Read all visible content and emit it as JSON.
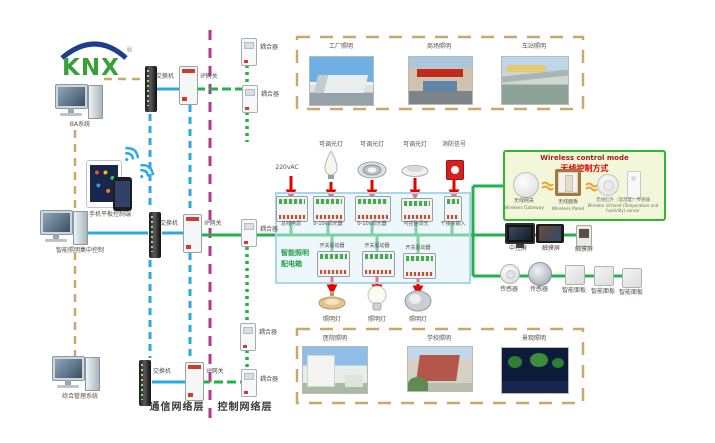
{
  "logo": {
    "brand": "KNX",
    "reg": "®"
  },
  "left_column": {
    "pc_ba_label": "BA系统",
    "mobile_label": "手机平板控制端",
    "pc_lighting_label": "智能照明集中控制",
    "pc_mgmt_label": "综合管理系统"
  },
  "network": {
    "switch_label": "交换机",
    "gateway_label": "IP网关",
    "coupler_label": "耦合器",
    "comm_layer_label": "通信网络层",
    "ctrl_layer_label": "控制网络层"
  },
  "scenes_top": [
    {
      "label": "工厂照明"
    },
    {
      "label": "商场照明"
    },
    {
      "label": "车站照明"
    }
  ],
  "scenes_bottom": [
    {
      "label": "医院照明"
    },
    {
      "label": "学校照明"
    },
    {
      "label": "景观照明"
    }
  ],
  "cabinet": {
    "title_line1": "智能照明",
    "title_line2": "配电箱",
    "power_label": "220vAC",
    "load_labels_top": [
      "可调光灯",
      "可调光灯",
      "可调光灯",
      "消防信号"
    ],
    "module_labels_top": [
      "总线电源",
      "0-10v调光器",
      "0-10v调光器",
      "可控硅调光",
      "干接点输入"
    ],
    "module_labels_bottom": [
      "开关驱动器",
      "开关驱动器",
      "开关驱动器"
    ],
    "load_labels_bottom": [
      "照明灯",
      "照明灯",
      "照明灯"
    ]
  },
  "wireless": {
    "title_en": "Wireless control mode",
    "title_zh": "无线控制方式",
    "items": [
      {
        "zh": "无线网关",
        "en": "Wireless Gateway"
      },
      {
        "zh": "无线面板",
        "en": "Wireless Panel"
      },
      {
        "zh": "无线红外（温湿度）传感器",
        "en": "Wireless infrared (Temperature and humidity) sensor"
      }
    ]
  },
  "control_devices": {
    "row1": [
      "中控屏",
      "触摸屏",
      "触摸屏"
    ],
    "row2": [
      "传感器",
      "传感器",
      "智能面板",
      "智能面板",
      "智能面板"
    ]
  },
  "colors": {
    "bus_green": "#21b24c",
    "lan_blue": "#29abe2",
    "layer_magenta": "#b53a8c",
    "mgmt_tan": "#c9a86a",
    "power_red": "#e60000",
    "cabinet_blue": "#a9d6ea",
    "wireless_green": "#2eb82e"
  }
}
